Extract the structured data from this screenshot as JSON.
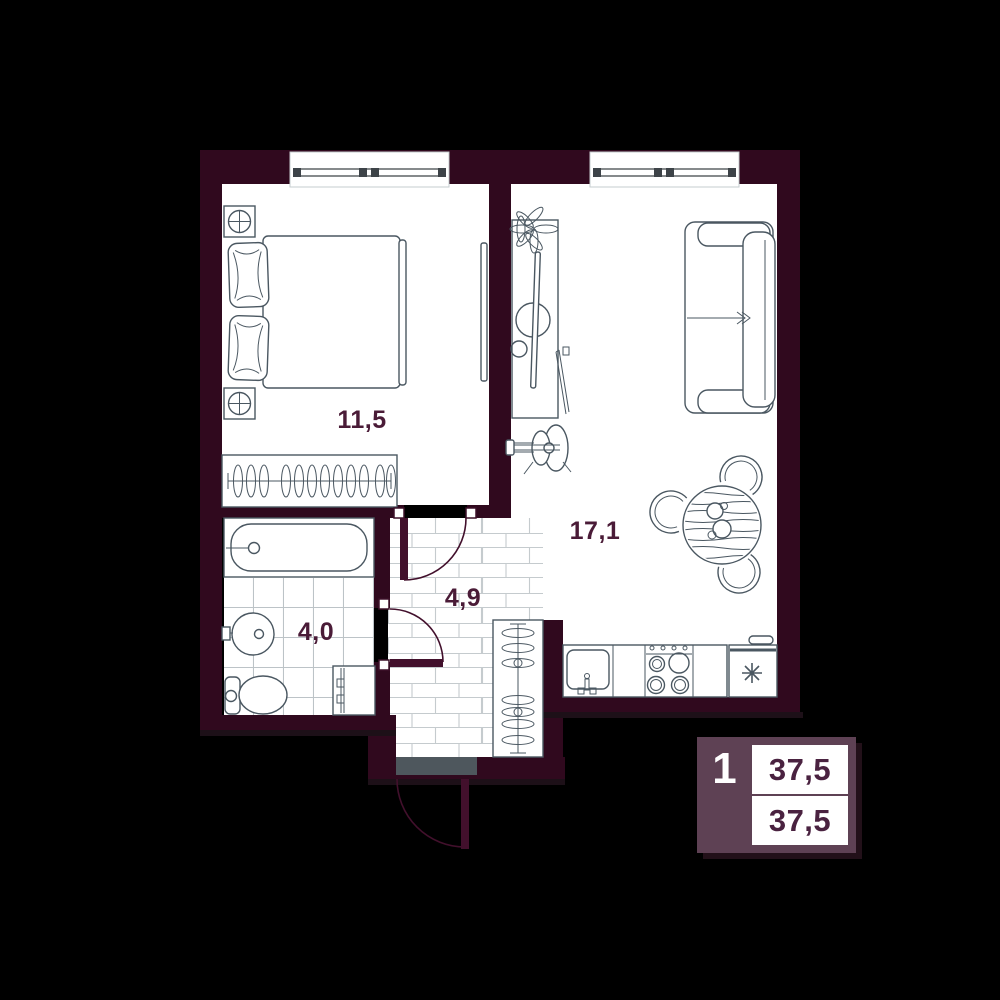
{
  "plan": {
    "type": "apartment-floor-plan-1-room",
    "rooms": [
      {
        "name": "bedroom",
        "area": "11,5"
      },
      {
        "name": "living-kitchen",
        "area": "17,1"
      },
      {
        "name": "hallway",
        "area": "4,9"
      },
      {
        "name": "bathroom",
        "area": "4,0"
      }
    ],
    "windows_count": 2,
    "fixtures": [
      "double-bed",
      "nightstand-lamp-top",
      "nightstand-lamp-bottom",
      "bedroom-wardrobe-hangers",
      "wall-tv",
      "tv-console",
      "plant",
      "leaning-frame",
      "guitar",
      "sofa",
      "dining-table",
      "chair",
      "chair",
      "chair",
      "kitchen-sink",
      "kitchen-stove",
      "fridge",
      "bathtub",
      "washbasin",
      "toilet",
      "washing-machine",
      "hall-wardrobe-hangers",
      "entrance-threshold",
      "entrance-door",
      "bedroom-door",
      "bathroom-door"
    ],
    "colors": {
      "background": "#000000",
      "wall": "#30091e",
      "floor": "#ffffff",
      "furniture_line": "#4a5761",
      "tile_line": "#bfc6c9",
      "label": "#4a1b37",
      "door": "#42102c",
      "threshold": "#4e575d"
    }
  },
  "badge": {
    "rooms_count": "1",
    "area_top": "37,5",
    "area_bottom": "37,5",
    "background": "#5e4154",
    "text_color": "#4a2240"
  }
}
